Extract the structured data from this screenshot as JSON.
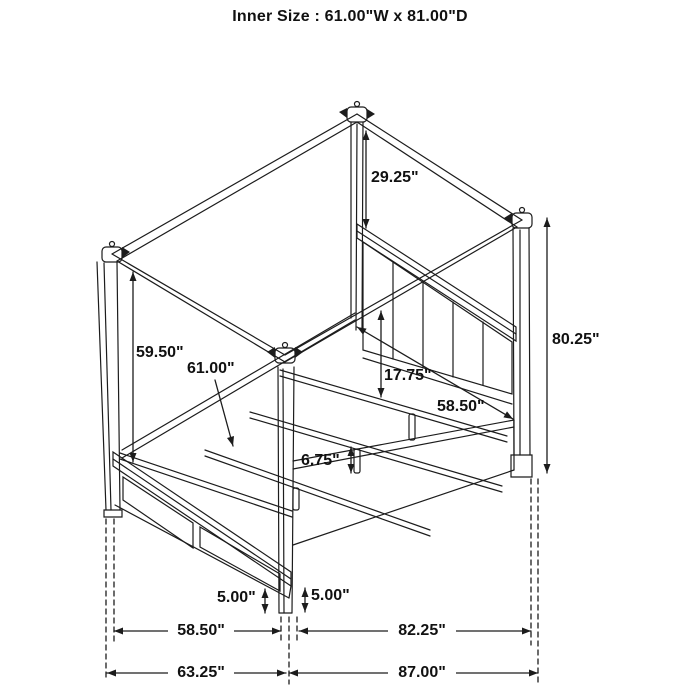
{
  "header": {
    "title": "Inner Size : 61.00\"W x 81.00\"D"
  },
  "figure": {
    "type": "technical-dimension-drawing",
    "subject": "four-poster canopy storage bed",
    "units": "inches"
  },
  "colors": {
    "line": "#1c1c1c",
    "background": "#ffffff",
    "text": "#111111"
  },
  "annotations": [
    {
      "id": "canopy-to-headboard-height",
      "label": "29.25\""
    },
    {
      "id": "overall-post-height",
      "label": "80.25\""
    },
    {
      "id": "canopy-underside-clearance",
      "label": "59.50\""
    },
    {
      "id": "slat-inner-width",
      "label": "61.00\""
    },
    {
      "id": "headboard-panel-height",
      "label": "17.75\""
    },
    {
      "id": "headboard-inner-width",
      "label": "58.50\""
    },
    {
      "id": "support-leg-height",
      "label": "6.75\""
    },
    {
      "id": "footboard-floor-clearance",
      "label": "5.00\""
    },
    {
      "id": "siderail-floor-clearance",
      "label": "5.00\""
    },
    {
      "id": "footboard-inner-width",
      "label": "58.50\""
    },
    {
      "id": "siderail-inner-length",
      "label": "82.25\""
    },
    {
      "id": "overall-width",
      "label": "63.25\""
    },
    {
      "id": "overall-depth",
      "label": "87.00\""
    }
  ]
}
